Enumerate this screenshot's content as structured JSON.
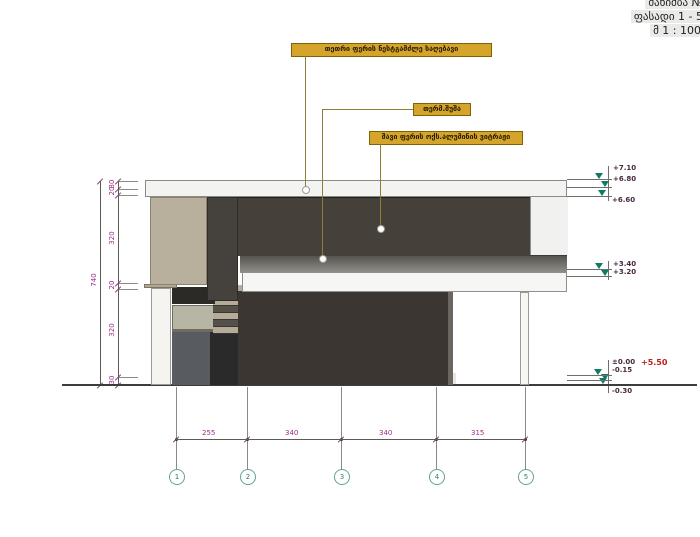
{
  "title_block": {
    "lines": [
      "მანიშბა №",
      "ფასადი 1 - 5",
      "მ 1 : 100"
    ]
  },
  "callouts": {
    "paint": "თეთრი ფერის ნესტგამძლე საღებავი",
    "glass": "თერმ.შუშა",
    "vitrage": "შავი ფერის ოქს.ალუმინის ვიტრაჟი"
  },
  "levels": [
    {
      "value": "+7.10",
      "tx": 613,
      "ty": 164,
      "line_y": 179,
      "arrow_x": 595
    },
    {
      "value": "+6.80",
      "tx": 613,
      "ty": 175,
      "line_y": 187,
      "arrow_x": 601
    },
    {
      "value": "+6.60",
      "tx": 612,
      "ty": 196,
      "line_y": 196,
      "arrow_x": 598
    },
    {
      "value": "+3.40",
      "tx": 613,
      "ty": 260,
      "line_y": 269,
      "arrow_x": 595
    },
    {
      "value": "+3.20",
      "tx": 613,
      "ty": 268,
      "line_y": 276,
      "arrow_x": 601
    },
    {
      "value": "±0.00",
      "tx": 612,
      "ty": 358,
      "line_y": 375,
      "arrow_x": 594
    },
    {
      "value": "-0.15",
      "tx": 612,
      "ty": 366,
      "line_y": 380,
      "arrow_x": 601
    },
    {
      "value": "-0.30",
      "tx": 612,
      "ty": 387,
      "line_y": 384,
      "arrow_x": 599
    }
  ],
  "level_extra": {
    "value": "+5.50",
    "tx": 641,
    "ty": 358
  },
  "level_stems": [
    {
      "x": 608,
      "y1": 166,
      "y2": 201
    },
    {
      "x": 608,
      "y1": 261,
      "y2": 280
    },
    {
      "x": 608,
      "y1": 360,
      "y2": 393
    }
  ],
  "dim_left": {
    "total": {
      "value": "740",
      "x": 92,
      "y": 280
    },
    "line_x": 118,
    "total_line_x": 100,
    "top_y": 181,
    "bottom_y": 385,
    "segments": [
      {
        "value": "30",
        "y": 184
      },
      {
        "value": "20",
        "y": 191
      },
      {
        "value": "320",
        "y": 238
      },
      {
        "value": "20",
        "y": 285
      },
      {
        "value": "320",
        "y": 330
      },
      {
        "value": "30",
        "y": 380
      }
    ],
    "bounds": [
      181,
      189,
      195,
      283,
      289,
      377,
      385
    ]
  },
  "dim_bottom": {
    "line_y": 439,
    "x1": 176,
    "x2": 525,
    "segments": [
      {
        "value": "255",
        "cx": 211
      },
      {
        "value": "340",
        "cx": 294
      },
      {
        "value": "340",
        "cx": 388
      },
      {
        "value": "315",
        "cx": 480
      }
    ],
    "ticks": [
      176,
      247,
      341,
      436,
      525
    ]
  },
  "axes": [
    {
      "n": "1",
      "x": 176
    },
    {
      "n": "2",
      "x": 247
    },
    {
      "n": "3",
      "x": 341
    },
    {
      "n": "4",
      "x": 436
    },
    {
      "n": "5",
      "x": 525
    }
  ]
}
